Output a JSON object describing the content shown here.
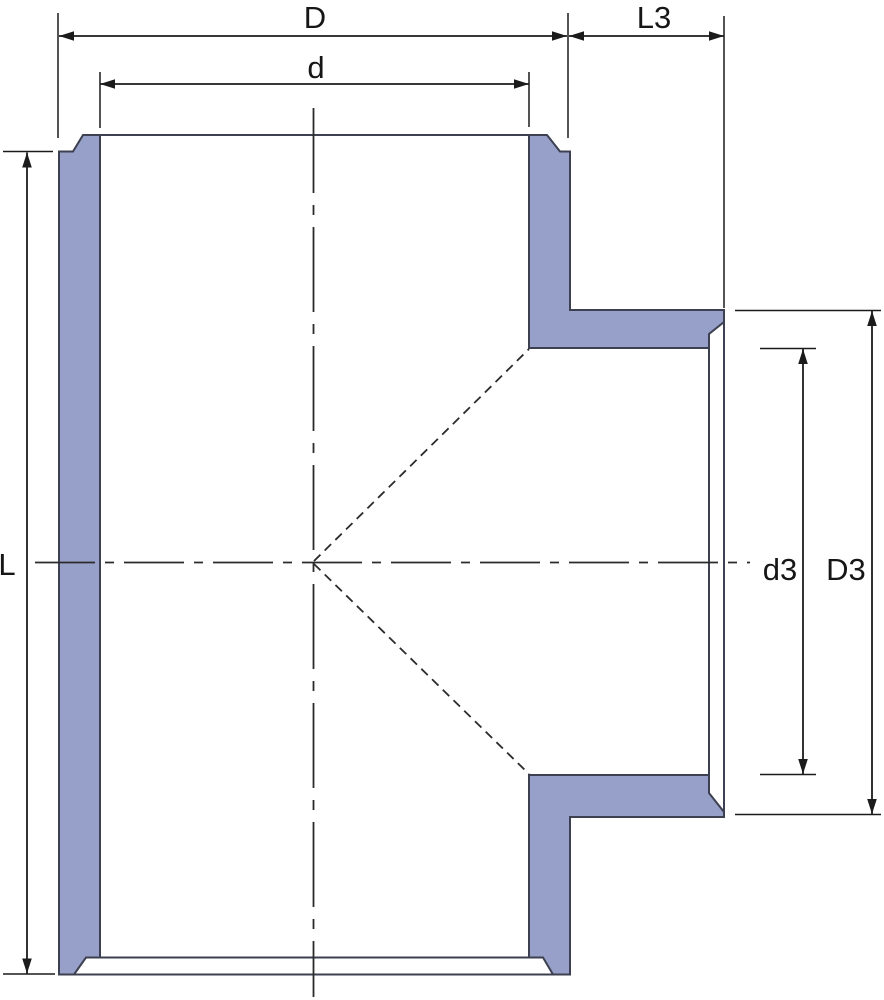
{
  "drawing": {
    "labels": {
      "D": "D",
      "d": "d",
      "L3": "L3",
      "L": "L",
      "d3": "d3",
      "D3": "D3"
    },
    "colors": {
      "wall_fill": "#97A0C9",
      "wall_outline": "#3C4050",
      "line": "#1B1B1B",
      "background": "#FFFFFF"
    }
  }
}
